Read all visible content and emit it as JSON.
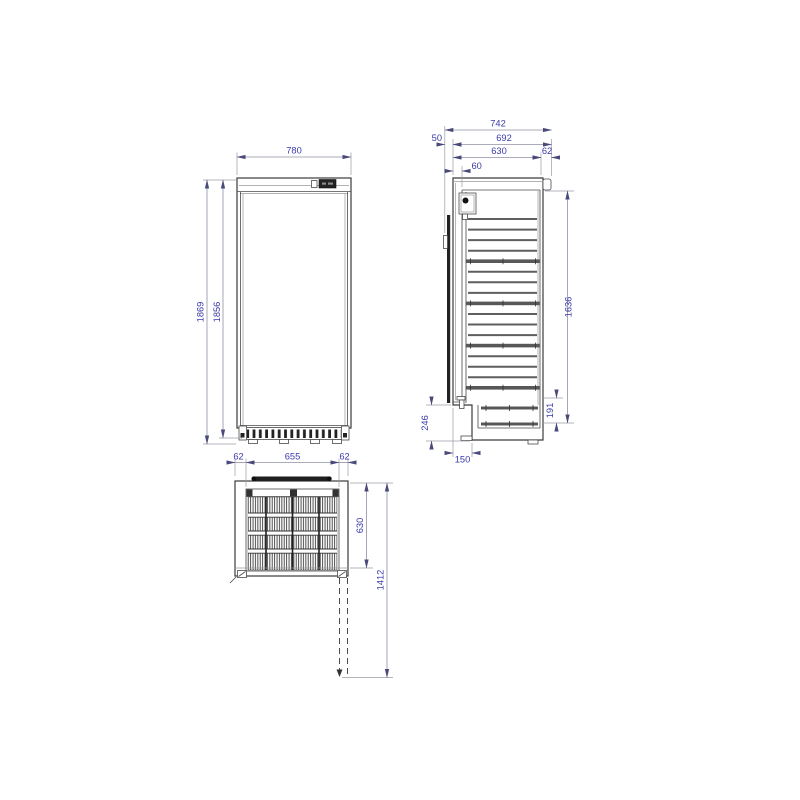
{
  "drawing_type": "refrigerator-dimensional-drawing",
  "dimensions": {
    "front": {
      "width": "780",
      "height_total": "1869",
      "height_body": "1856"
    },
    "side": {
      "depth_total": "742",
      "handle_depth": "50",
      "depth_with_door": "692",
      "body_depth": "630",
      "rear_gap": "62",
      "door_thickness": "60",
      "interior_height": "1636",
      "base_height": "191",
      "recess_height": "246",
      "recess_depth": "150"
    },
    "top": {
      "left_inset": "62",
      "grille_width": "655",
      "right_inset": "62",
      "body_depth": "630",
      "open_door_depth": "1412"
    }
  },
  "colors": {
    "dimension_text": "#3a3aab",
    "dimension_line": "#8f8fa3",
    "outline": "#3b3b3b",
    "dark_fill": "#1f1f1f"
  }
}
